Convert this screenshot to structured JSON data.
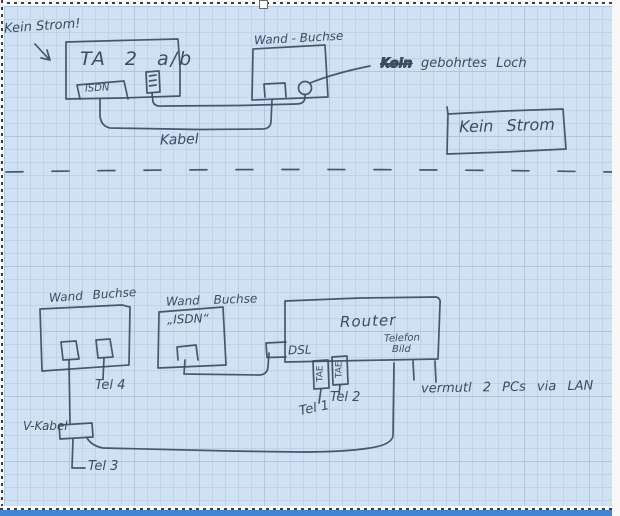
{
  "colors": {
    "paper": "#cfe1f2",
    "grid": "#bdd3ea",
    "grid_strong": "#adc7e2",
    "ink": "#3a4d63",
    "bottom_bar": "#4186d4"
  },
  "diagram": {
    "top": {
      "no_power_note": "Kein Strom!",
      "ta_box_title": "TA 2 a/b",
      "isdn_port": "ISDN",
      "wall_socket_label": "Wand - Buchse",
      "hole_note_word1": "Kein",
      "hole_note_rest": "gebohrtes Loch",
      "cable_label": "Kabel",
      "no_power_box": "Kein Strom"
    },
    "bottom": {
      "left_wall_socket_label": "Wand Buchse",
      "tel4": "Tel 4",
      "v_cable_label": "V-Kabel",
      "tel3": "Tel 3",
      "isdn_wall_socket_label": "Wand Buchse",
      "isdn_wall_socket_sublabel": "„ISDN“",
      "router_title": "Router",
      "dsl_port": "DSL",
      "tae_port_1": "TAE",
      "tae_port_2": "TAE",
      "telefon_port_line1": "Telefon",
      "telefon_port_line2": "Bild",
      "tel1": "Tel 1",
      "tel2": "Tel 2",
      "lan_note": "vermutl 2 PCs via LAN"
    }
  }
}
